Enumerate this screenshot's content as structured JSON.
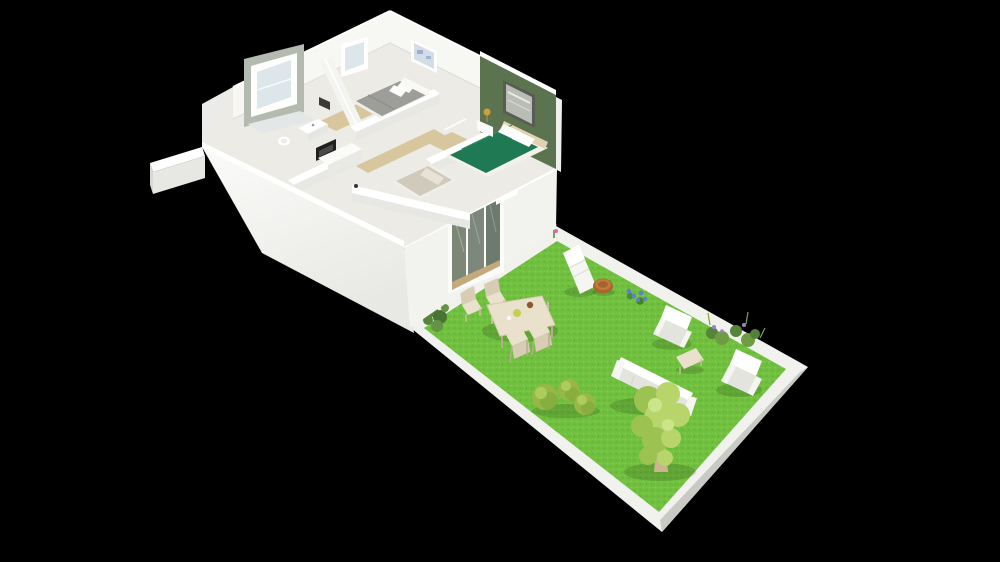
{
  "scene": {
    "type": "isometric-3d-floor-plan-render",
    "description": "Cutaway 3D render of a single-storey house with furnished rooms, seen from above at an angle, with an attached landscaped garden on a black background",
    "background": "#000000",
    "visible_text": ""
  },
  "palette": {
    "background": "#000000",
    "wall-white": "#f7f7f4",
    "wall-shadow": "#e7e7e4",
    "wall-highlight": "#ffffff",
    "facade-white": "#f2f2ef",
    "floor-cream": "#edebe5",
    "accent-wall-green": "#5c7350",
    "wood-floor-tan": "#d8c69e",
    "gray-bed": "#9d9d99",
    "beige-bed": "#d0cabd",
    "green-bed": "#1f7a53",
    "curb-white": "#f1f1ee",
    "lawn-green": "#70bf3f",
    "lawn-light": "#85d355",
    "lawn-dark": "#5aa72f",
    "outdoor-wood": "#e9e1cc",
    "outdoor-wood-shade": "#d8cdb4",
    "white-furniture": "#f5f5f1",
    "white-furniture-shade": "#e4e4df",
    "table-brown": "#a9652e",
    "tree-foliage": "#b7d56b",
    "tree-foliage-dark": "#9cc252",
    "bush-green": "#97b848",
    "bush-green-dark": "#7fa63c",
    "shrub-dark": "#55843a",
    "glass-dark": "#76816f",
    "glass-light": "#dde6ea",
    "appliance-black": "#1f1f1d",
    "flower-pink": "#e06a9a",
    "flower-blue": "#5f7fd6",
    "flower-purple": "#9f7fd0",
    "lamp-gold": "#c9a23a",
    "trunk-tan": "#c9b48e"
  },
  "house": {
    "storeys": 1,
    "view": "roofless cutaway, camera from south-west above",
    "rooms": [
      "bathroom",
      "bedroom-1",
      "hallway-kitchen",
      "bedroom-2-master",
      "bedroom-3"
    ],
    "walls": {
      "accent_wall": {
        "room": "bedroom-2-master",
        "color": "#5c7350",
        "decor": "framed picture"
      },
      "bay_window": {
        "room": "bathroom",
        "frame_color": "#b5bab0"
      },
      "windows": 3,
      "interior_doors_open": 3
    },
    "furniture": [
      {
        "name": "double-bed",
        "room": "bedroom-1",
        "bedding_color": "#9d9d99",
        "pillows": 2
      },
      {
        "name": "double-bed",
        "room": "bedroom-2-master",
        "bedding_color": "#1f7a53",
        "pillows": 2
      },
      {
        "name": "single-bed",
        "room": "bedroom-3",
        "bedding_color": "#d0cabd",
        "pillows": 1
      },
      {
        "name": "nightstand-with-gold-lamp",
        "room": "bedroom-2-master"
      },
      {
        "name": "kitchen-counter",
        "room": "hallway-kitchen"
      },
      {
        "name": "dark-appliance",
        "room": "hallway-kitchen",
        "color": "#1f1f1d"
      },
      {
        "name": "wash-basin",
        "room": "bathroom"
      },
      {
        "name": "toilet",
        "room": "bathroom"
      }
    ],
    "openings": [
      {
        "name": "sliding-glass-door",
        "wall": "garden-facing",
        "panes": 3
      },
      {
        "name": "small-window",
        "wall": "garden-facing"
      }
    ]
  },
  "garden": {
    "ground": "bright green lawn with white curb border",
    "items": [
      {
        "name": "chaise-lounge",
        "color": "white",
        "count": 1
      },
      {
        "name": "round-side-table",
        "color": "#a9652e",
        "count": 1
      },
      {
        "name": "dining-table",
        "color": "light wood",
        "count": 1
      },
      {
        "name": "dining-chair",
        "color": "light wood",
        "count": 4
      },
      {
        "name": "armchair",
        "color": "white",
        "count": 2
      },
      {
        "name": "sofa",
        "color": "white",
        "count": 1
      },
      {
        "name": "coffee-table",
        "color": "light wood",
        "count": 1
      },
      {
        "name": "round-bush",
        "count": 3
      },
      {
        "name": "tree",
        "foliage": "#b7d56b",
        "count": 1
      },
      {
        "name": "pink-flower-cluster",
        "count": 1
      },
      {
        "name": "blue-flower-cluster",
        "count": 1
      },
      {
        "name": "purple-flower-shrubs",
        "count": 2
      },
      {
        "name": "dark-green-shrub",
        "count": 1
      },
      {
        "name": "grass-tufts",
        "count": 4
      }
    ]
  }
}
